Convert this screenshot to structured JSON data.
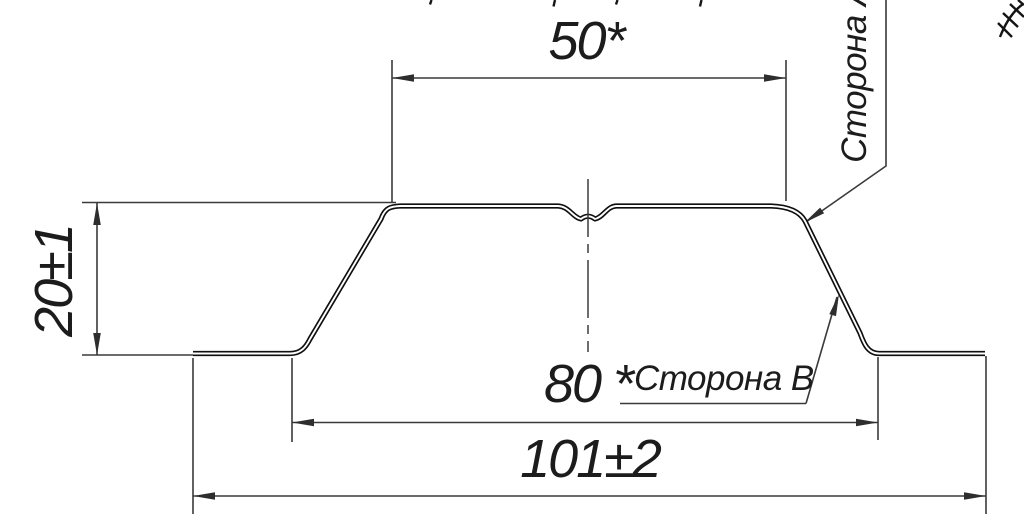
{
  "drawing": {
    "kind": "profile-cross-section",
    "colors": {
      "outline": "#0f0f0f",
      "dim_lines": "#3a3a3a",
      "text": "#1c1c1c",
      "background": "#ffffff"
    },
    "dimensions": {
      "top_width": "50*",
      "height": "20±1",
      "inner_width": "80 *",
      "overall_width": "101±2"
    },
    "labels": {
      "side_a": "Сторона А",
      "side_b": "Сторона В"
    }
  }
}
